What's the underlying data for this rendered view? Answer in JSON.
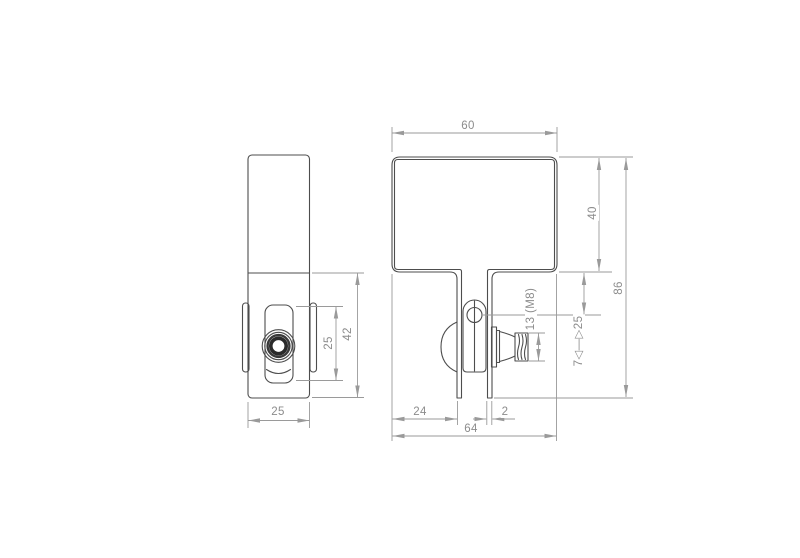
{
  "colors": {
    "background": "#ffffff",
    "part_line": "#4d4d4d",
    "knob_ring": "#2b2b2b",
    "dimension_line": "#9a9a9a",
    "label_text": "#8c8c8c"
  },
  "side_view": {
    "plate_height_label": "25",
    "lower_height_label": "42",
    "width_label": "25"
  },
  "front_view": {
    "top_width_label": "60",
    "box_height_label": "40",
    "overall_height_label": "86",
    "knob_label": "13 (M8)",
    "clamp_range_label": "7◁—▷25",
    "leg_offset_label": "24",
    "thickness_label": "2",
    "overall_width_label": "64"
  }
}
